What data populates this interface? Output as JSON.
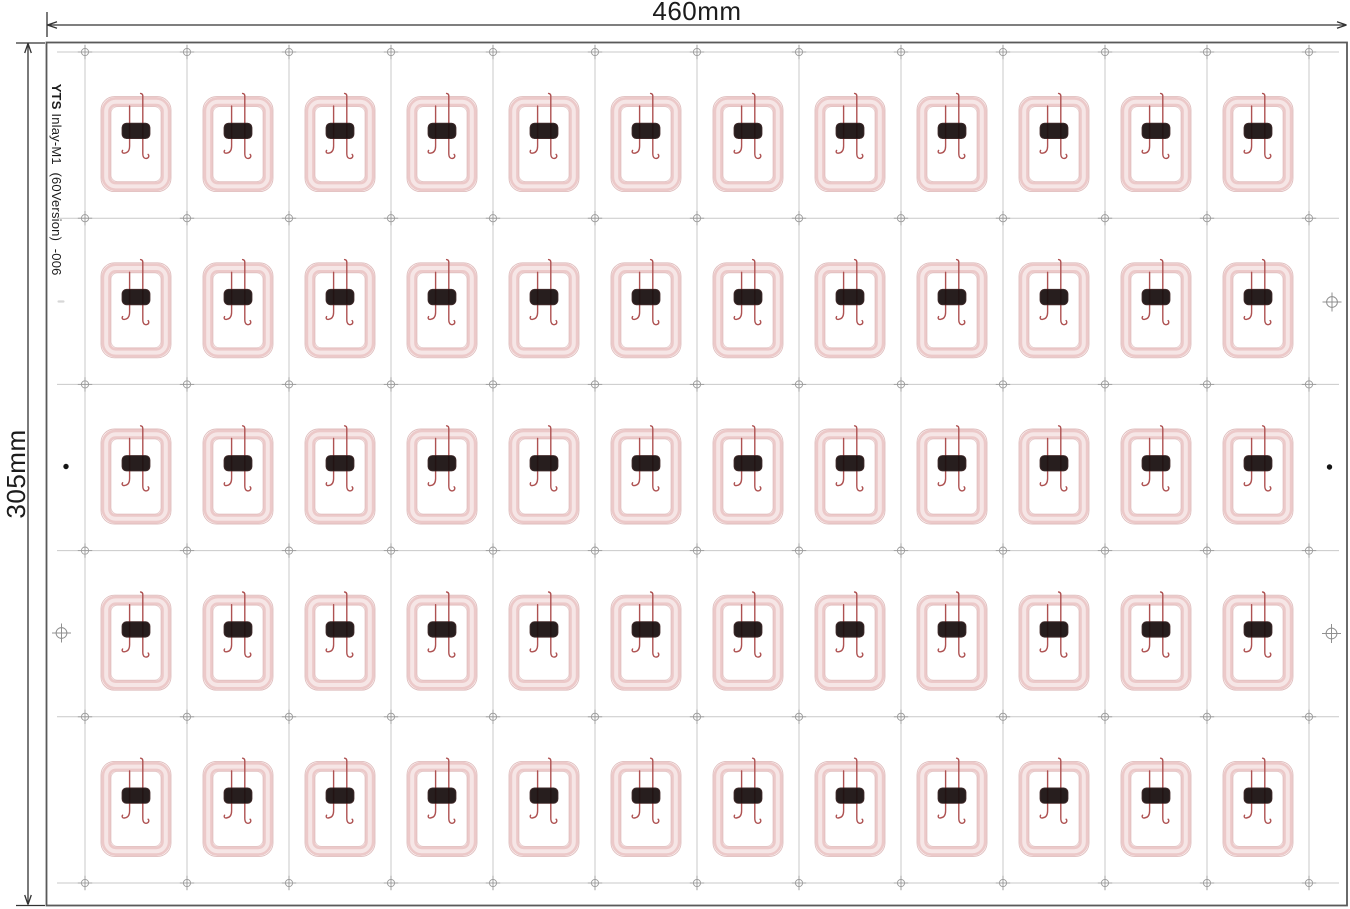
{
  "labels": {
    "width_dim": "460mm",
    "height_dim": "305mm",
    "sheet_code_bold": "YTS",
    "sheet_code_rest": " Inlay-M1  (60Version)  -006"
  },
  "sheet": {
    "x": 46.5,
    "y": 42.5,
    "w": 1300.5,
    "h": 863
  },
  "grid": {
    "rows": 5,
    "cols": 12,
    "total_inlays": 60,
    "x0": 85,
    "dx": 102,
    "y0": 52,
    "y1": 883,
    "h_ext_x1": 57,
    "h_ext_x2": 1339,
    "v_ext_y1": 45,
    "v_ext_y2": 890
  },
  "inlay": {
    "width": 70,
    "height": 95,
    "center_offset_y": 9
  },
  "dims": {
    "top_line_y": 25,
    "top_x1": 47.5,
    "top_x2": 1346.5,
    "top_tick_x": 47,
    "left_line_x": 28,
    "left_y1": 43.5,
    "left_y2": 904.5,
    "left_tick_y_top": 43,
    "left_tick_y_bottom": 905.5,
    "width_label_x": 697,
    "width_label_y": 20,
    "height_label_x": 25,
    "height_label_y": 474,
    "code_x": 52,
    "code_y": 57
  },
  "margin_marks": {
    "left": [
      {
        "type": "dash",
        "x": 61,
        "y": 301.5
      },
      {
        "type": "dot",
        "x": 66,
        "y": 466.5
      },
      {
        "type": "crosshair",
        "x": 61.5,
        "y": 633
      }
    ],
    "right": [
      {
        "type": "crosshair",
        "x": 1332,
        "y": 302
      },
      {
        "type": "dot",
        "x": 1329.5,
        "y": 467
      },
      {
        "type": "crosshair",
        "x": 1331.5,
        "y": 633.5
      }
    ]
  },
  "colors": {
    "coil": "#ecc9c9",
    "coil_edge": "#d9b1b1",
    "coil_gloss": "#f7e8e8",
    "wire": "#ae5252",
    "chip": "#1a1010",
    "grid_line": "#c9c9c9",
    "reg_mark": "#9b9b9b",
    "margin_mark": "#8f8f8f",
    "border": "#5a5a5a",
    "dim": "#333333",
    "text": "#1c1c1c",
    "dot": "#151515"
  }
}
